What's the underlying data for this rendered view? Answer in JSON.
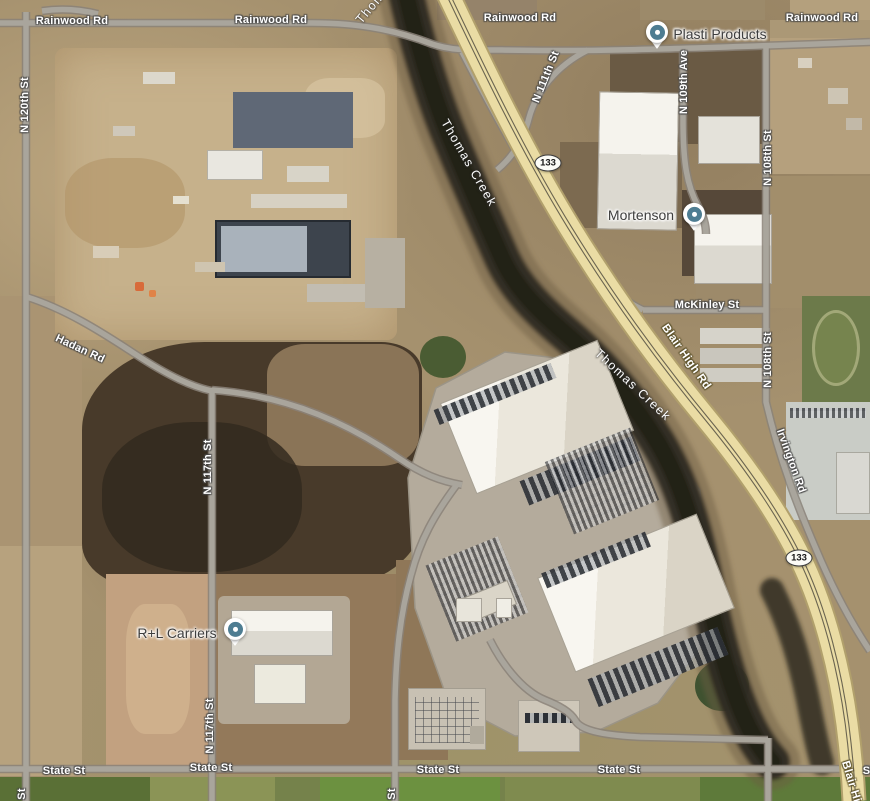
{
  "map": {
    "colors": {
      "highway_fill": "#eadca4",
      "highway_casing": "#b1a06c",
      "highway_centerline": "#6b6550",
      "road_fill": "#a9a59c",
      "road_casing": "#8a8279",
      "creek_dark": "#2f2a21",
      "marker_teal": "#4e7d92",
      "road_label_color": "#ffffff",
      "poi_label_color": "#3e3e3e"
    },
    "labels": [
      {
        "id": "rainwood-rd-1",
        "text": "Rainwood Rd",
        "x": 72,
        "y": 21,
        "rot": 0,
        "kind": "road"
      },
      {
        "id": "rainwood-rd-2",
        "text": "Rainwood Rd",
        "x": 271,
        "y": 20,
        "rot": 0,
        "kind": "road"
      },
      {
        "id": "rainwood-rd-3",
        "text": "Rainwood Rd",
        "x": 520,
        "y": 18,
        "rot": 0,
        "kind": "road"
      },
      {
        "id": "rainwood-rd-4",
        "text": "Rainwood Rd",
        "x": 822,
        "y": 18,
        "rot": 0,
        "kind": "road"
      },
      {
        "id": "n-120th-st",
        "text": "N 120th St",
        "x": 25,
        "y": 105,
        "rot": -90,
        "kind": "road"
      },
      {
        "id": "n-120th-st-partial",
        "text": "St",
        "x": 22,
        "y": 794,
        "rot": -90,
        "kind": "road"
      },
      {
        "id": "thomas-creek-top",
        "text": "Thomas Creek",
        "x": 390,
        "y": -16,
        "rot": -50,
        "kind": "creek"
      },
      {
        "id": "thomas-creek-1",
        "text": "Thomas Creek",
        "x": 469,
        "y": 163,
        "rot": 60,
        "kind": "creek"
      },
      {
        "id": "thomas-creek-2",
        "text": "Thomas Creek",
        "x": 633,
        "y": 385,
        "rot": 43,
        "kind": "creek"
      },
      {
        "id": "n-111th-st",
        "text": "N 111th St",
        "x": 546,
        "y": 77,
        "rot": -68,
        "kind": "road"
      },
      {
        "id": "n-109th-ave",
        "text": "N 109th Ave",
        "x": 684,
        "y": 82,
        "rot": -90,
        "kind": "road"
      },
      {
        "id": "n-108th-st-1",
        "text": "N 108th St",
        "x": 768,
        "y": 158,
        "rot": -90,
        "kind": "road"
      },
      {
        "id": "n-108th-st-2",
        "text": "N 108th St",
        "x": 768,
        "y": 360,
        "rot": -90,
        "kind": "road"
      },
      {
        "id": "mckinley-st",
        "text": "McKinley St",
        "x": 707,
        "y": 305,
        "rot": 0,
        "kind": "road"
      },
      {
        "id": "blair-high-rd-1",
        "text": "Blair High Rd",
        "x": 686,
        "y": 357,
        "rot": 55,
        "kind": "highway"
      },
      {
        "id": "blair-high-rd-2",
        "text": "Blair High Rd",
        "x": 856,
        "y": 798,
        "rot": 73,
        "kind": "highway"
      },
      {
        "id": "irvington-rd",
        "text": "Irvington Rd",
        "x": 791,
        "y": 461,
        "rot": 70,
        "kind": "road"
      },
      {
        "id": "hadan-rd",
        "text": "Hadan Rd",
        "x": 80,
        "y": 349,
        "rot": 25,
        "kind": "road"
      },
      {
        "id": "n-117th-st-1",
        "text": "N 117th St",
        "x": 208,
        "y": 467,
        "rot": -90,
        "kind": "road"
      },
      {
        "id": "n-117th-st-2",
        "text": "N 117th St",
        "x": 210,
        "y": 726,
        "rot": -90,
        "kind": "road"
      },
      {
        "id": "state-st-1",
        "text": "State St",
        "x": 64,
        "y": 771,
        "rot": 0,
        "kind": "road"
      },
      {
        "id": "state-st-2",
        "text": "State St",
        "x": 211,
        "y": 768,
        "rot": 0,
        "kind": "road"
      },
      {
        "id": "state-st-3",
        "text": "State St",
        "x": 438,
        "y": 770,
        "rot": 0,
        "kind": "road"
      },
      {
        "id": "state-st-4",
        "text": "State St",
        "x": 619,
        "y": 770,
        "rot": 0,
        "kind": "road"
      },
      {
        "id": "state-st-5",
        "text": "State St",
        "x": 884,
        "y": 771,
        "rot": 0,
        "kind": "road"
      },
      {
        "id": "st-partial-bottom",
        "text": "St",
        "x": 392,
        "y": 794,
        "rot": -90,
        "kind": "road"
      }
    ],
    "pois": [
      {
        "id": "plasti-products",
        "name": "Plasti Products",
        "marker_x": 657,
        "marker_y": 32,
        "label_x": 720,
        "label_y": 34
      },
      {
        "id": "mortenson",
        "name": "Mortenson",
        "marker_x": 694,
        "marker_y": 214,
        "label_x": 641,
        "label_y": 215
      },
      {
        "id": "r-l-carriers",
        "name": "R+L Carriers",
        "marker_x": 235,
        "marker_y": 629,
        "label_x": 177,
        "label_y": 633
      }
    ],
    "shields": [
      {
        "id": "route-133-north",
        "text": "133",
        "x": 548,
        "y": 163
      },
      {
        "id": "route-133-south",
        "text": "133",
        "x": 799,
        "y": 558
      }
    ]
  }
}
